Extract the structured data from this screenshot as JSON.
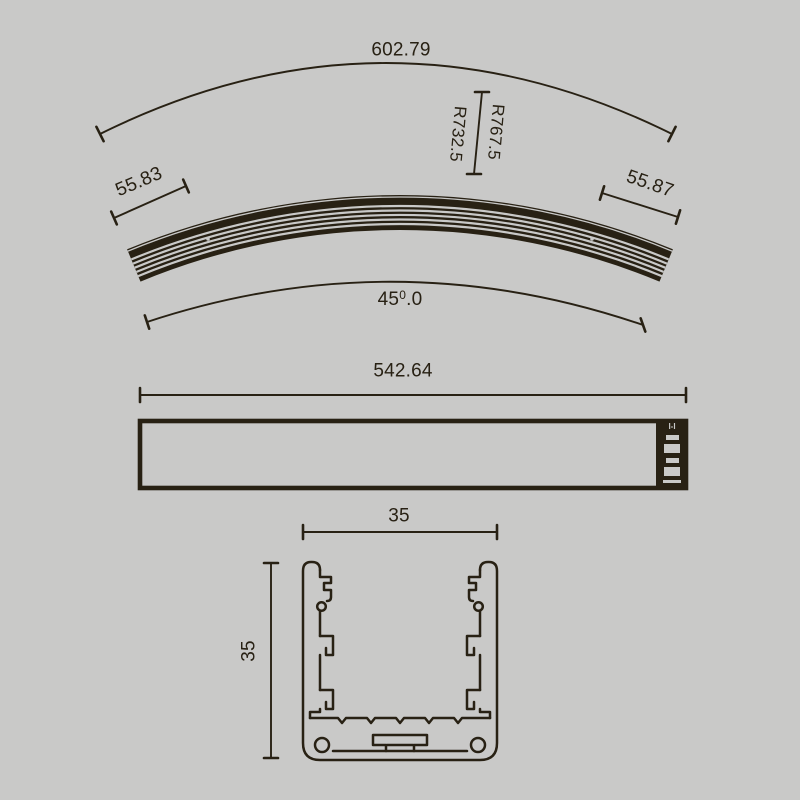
{
  "title": "curved-profile-technical-drawing",
  "colors": {
    "background": "#c9c9c8",
    "ink": "#282114"
  },
  "views": {
    "top": {
      "chord_length": "602.79",
      "outer_radius": "R767.5",
      "inner_radius": "R732.5",
      "left_end_width": "55.83",
      "right_end_width": "55.87",
      "angle": {
        "value": "45",
        "sup": "0",
        "decimals": ".0"
      }
    },
    "side": {
      "length": "542.64",
      "section_label": "I-I"
    },
    "section": {
      "width": "35",
      "height": "35"
    }
  }
}
